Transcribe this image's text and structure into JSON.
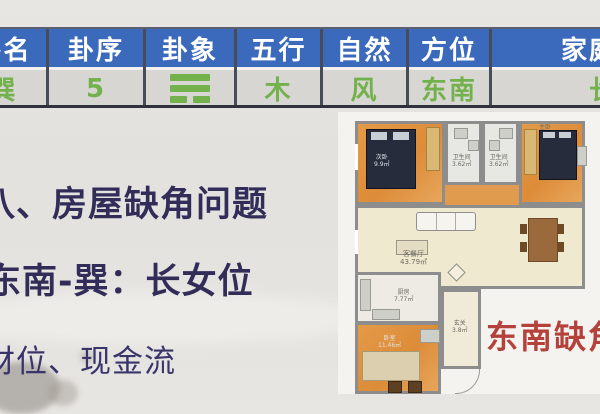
{
  "table": {
    "columns": [
      {
        "header": "卦名",
        "value": "巽"
      },
      {
        "header": "卦序",
        "value": "5"
      },
      {
        "header": "卦象",
        "value": "☴"
      },
      {
        "header": "五行",
        "value": "木"
      },
      {
        "header": "自然",
        "value": "风"
      },
      {
        "header": "方位",
        "value": "东南"
      },
      {
        "header": "家庭成员",
        "value": "长女"
      }
    ],
    "colors": {
      "header_bg": "#3b69bb",
      "header_text": "#ffffff",
      "row_bg": "#d8d6d3",
      "value_text": "#72b14b",
      "divider": "#474c58"
    }
  },
  "content": {
    "heading1": "八、房屋缺角问题",
    "heading2": "东南-巽：长女位",
    "line3": "财位、现金流",
    "text_color": "#312d58"
  },
  "floorplan": {
    "annotation": {
      "text": "东南缺角",
      "color": "#b5413b"
    },
    "rooms": {
      "bedroom_tl": {
        "name": "次卧",
        "area": "9.9㎡"
      },
      "bath_left": {
        "name": "卫生间",
        "area": "3.62㎡"
      },
      "bath_right": {
        "name": "卫生间",
        "area": "3.62㎡"
      },
      "bedroom_tr": {
        "name": "主卧",
        "area": ""
      },
      "living": {
        "name": "客餐厅",
        "area": "43.79㎡"
      },
      "kitchen": {
        "name": "厨房",
        "area": "7.77㎡"
      },
      "bedroom_bottom": {
        "name": "卧室",
        "area": "11.46㎡"
      },
      "entry": {
        "name": "玄关",
        "area": "3.8㎡"
      }
    }
  }
}
